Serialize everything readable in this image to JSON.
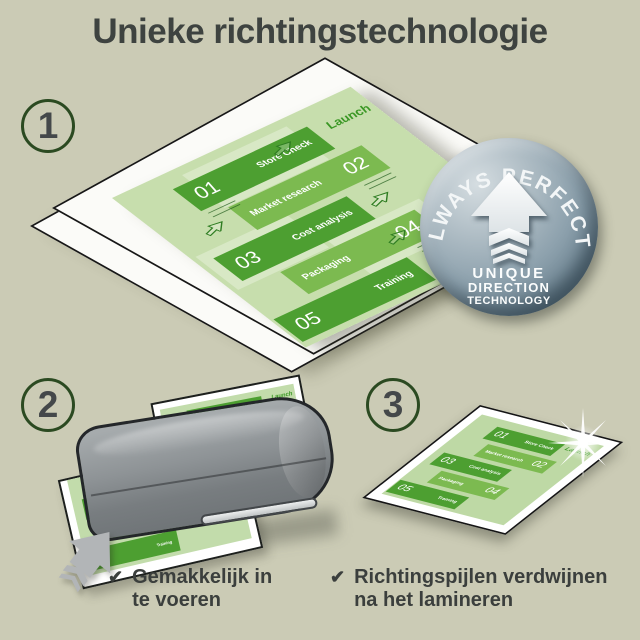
{
  "title": "Unieke richtingstechnologie",
  "steps": {
    "one": "1",
    "two": "2",
    "three": "3"
  },
  "badge": {
    "arc_text": "ALWAYS PERFECT!",
    "line1": "UNIQUE",
    "line2": "DIRECTION",
    "line3": "TECHNOLOGY"
  },
  "infographic": {
    "launch": "Launch",
    "bands": [
      {
        "num": "01",
        "label": "Store Check"
      },
      {
        "num": "02",
        "label": "Market research"
      },
      {
        "num": "03",
        "label": "Cost analysis"
      },
      {
        "num": "04",
        "label": "Packaging"
      },
      {
        "num": "05",
        "label": "Training"
      }
    ]
  },
  "checklist": {
    "check_icon": "✔",
    "item1": "Gemakkelijk in te voeren",
    "item2": "Richtingspijlen verdwijnen na het lamineren"
  },
  "colors": {
    "background": "#cbcbb5",
    "text": "#3e4340",
    "band_green_dark": "#4d9f31",
    "band_green_light": "#7cba50",
    "pouch_green": "#c4dca8",
    "launch_green": "#3a9724",
    "badge_gray_blue": "#8da1ad",
    "laminator_gray": "#8e9396"
  }
}
